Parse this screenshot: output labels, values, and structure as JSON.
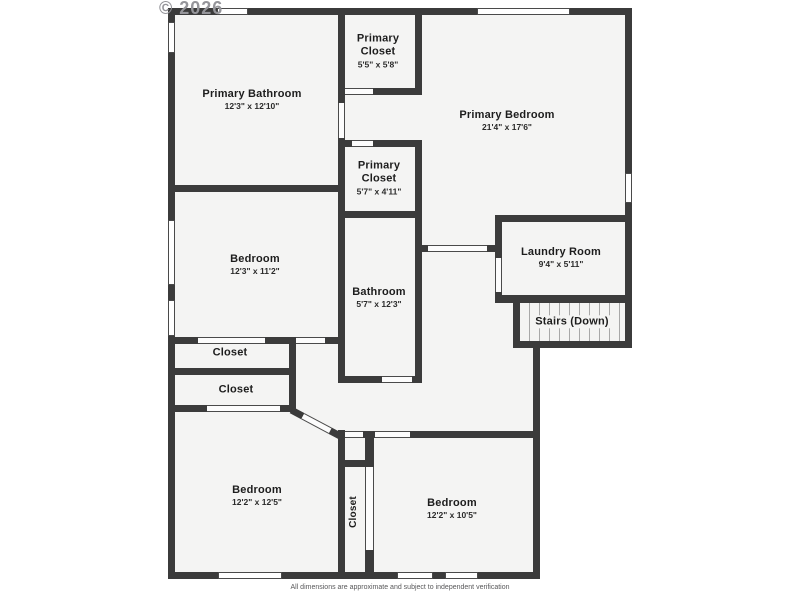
{
  "watermark": "© 2026",
  "disclaimer": "All dimensions are approximate and subject to independent verification",
  "colors": {
    "wall": "#3b3b3b",
    "floor": "#f4f4f3",
    "background": "#ffffff",
    "label_text": "#1d1d1d",
    "watermark": "#95959a",
    "stair_tread": "#a8a8a8"
  },
  "floorplan": {
    "type": "residential-floor-plan-upper-level",
    "rooms": [
      {
        "name": "Primary Bathroom",
        "dimensions": "12'3\" x 12'10\""
      },
      {
        "name": "Primary Closet",
        "dimensions": "5'5\" x 5'8\""
      },
      {
        "name": "Primary Bedroom",
        "dimensions": "21'4\" x 17'6\""
      },
      {
        "name": "Primary Closet",
        "dimensions": "5'7\" x 4'11\""
      },
      {
        "name": "Bedroom",
        "dimensions": "12'3\" x 11'2\""
      },
      {
        "name": "Laundry Room",
        "dimensions": "9'4\" x 5'11\""
      },
      {
        "name": "Bathroom",
        "dimensions": "5'7\" x 12'3\""
      },
      {
        "name": "Stairs (Down)",
        "dimensions": ""
      },
      {
        "name": "Closet",
        "dimensions": ""
      },
      {
        "name": "Closet",
        "dimensions": ""
      },
      {
        "name": "Bedroom",
        "dimensions": "12'2\" x 12'5\""
      },
      {
        "name": "Bedroom",
        "dimensions": "12'2\" x 10'5\""
      },
      {
        "name": "Closet",
        "dimensions": ""
      }
    ]
  }
}
